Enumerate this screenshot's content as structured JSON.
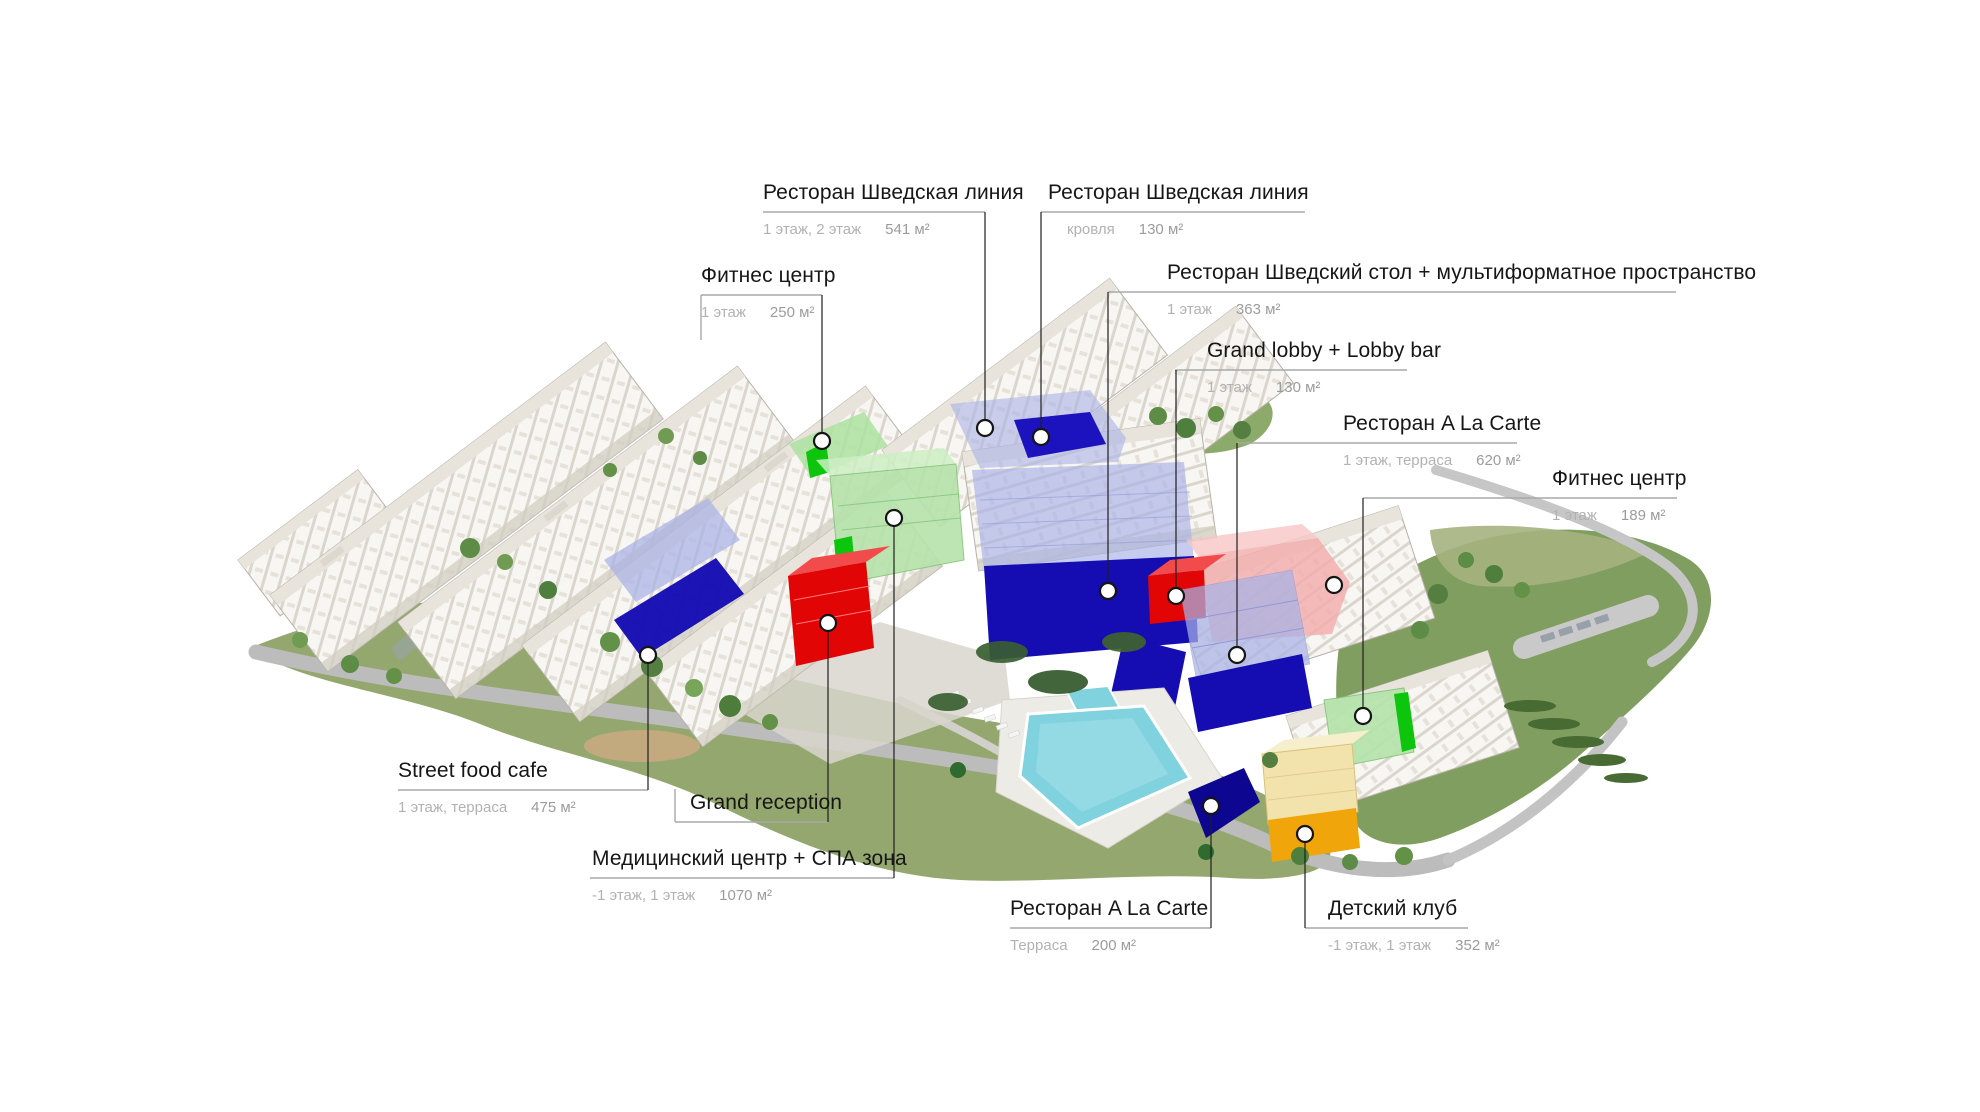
{
  "canvas": {
    "width": 1980,
    "height": 1112,
    "background": "#ffffff"
  },
  "palette": {
    "highlight_navy": "#150cb2",
    "highlight_periwinkle": "#a9b2e6",
    "highlight_bright_green": "#0cc50c",
    "highlight_light_green": "#b5e3ab",
    "highlight_red": "#e10505",
    "highlight_pink": "#f2abab",
    "highlight_amber": "#f0a60a",
    "pool_water": "#7fd2de",
    "leader_line": "#1f1f1f",
    "rule_line": "#a8a8a8",
    "title_text": "#161616",
    "floors_text": "#b2b2b2",
    "area_text": "#9c9c9c"
  },
  "callouts": [
    {
      "id": "restaurant-swedish-line",
      "title": "Ресторан Шведская линия",
      "floors": "1 этаж, 2 этаж",
      "area": "541 м²",
      "x": 763,
      "rule": {
        "x1": 763,
        "x2": 985,
        "y": 212
      },
      "leader": {
        "x": 985,
        "y1": 212,
        "y2": 428
      },
      "dot": {
        "x": 985,
        "y": 428
      }
    },
    {
      "id": "restaurant-swedish-line-roof",
      "title": "Ресторан Шведская линия",
      "floors": "кровля",
      "area": "130 м²",
      "x": 1048,
      "sub_x": 1067,
      "rule": {
        "x1": 1041,
        "x2": 1305,
        "y": 212
      },
      "leader": {
        "x": 1041,
        "y1": 212,
        "y2": 437
      },
      "dot": {
        "x": 1041,
        "y": 437
      }
    },
    {
      "id": "fitness-center-west",
      "title": "Фитнес центр",
      "floors": "1 этаж",
      "area": "250 м²",
      "x": 701,
      "rule": {
        "x1": 701,
        "x2": 822,
        "y": 295
      },
      "leader": {
        "x": 822,
        "y1": 295,
        "y2": 441
      },
      "dot": {
        "x": 822,
        "y": 441
      },
      "stub": {
        "x": 701,
        "y1": 295,
        "y2": 340
      }
    },
    {
      "id": "restaurant-buffet-multiformat",
      "title": "Ресторан Шведский стол + мультиформатное пространство",
      "floors": "1 этаж",
      "area": "363 м²",
      "x": 1167,
      "rule": {
        "x1": 1108,
        "x2": 1676,
        "y": 292
      },
      "leader": {
        "x": 1108,
        "y1": 292,
        "y2": 591
      },
      "dot": {
        "x": 1108,
        "y": 591
      }
    },
    {
      "id": "grand-lobby",
      "title": "Grand lobby + Lobby bar",
      "floors": "1 этаж",
      "area": "130 м²",
      "x": 1207,
      "rule": {
        "x1": 1175,
        "x2": 1407,
        "y": 370
      },
      "leader": {
        "x": 1176,
        "y1": 370,
        "y2": 596
      },
      "dot": {
        "x": 1176,
        "y": 596
      }
    },
    {
      "id": "restaurant-a-la-carte",
      "title": "Ресторан A La Carte",
      "floors": "1 этаж, терраса",
      "area": "620 м²",
      "x": 1343,
      "rule": {
        "x1": 1237,
        "x2": 1517,
        "y": 443
      },
      "leader": {
        "x": 1237,
        "y1": 443,
        "y2": 655
      },
      "dot": {
        "x": 1237,
        "y": 655
      }
    },
    {
      "id": "fitness-center-east",
      "title": "Фитнес центр",
      "floors": "1 этаж",
      "area": "189 м²",
      "x": 1552,
      "rule": {
        "x1": 1363,
        "x2": 1677,
        "y": 498
      },
      "leader": {
        "x": 1363,
        "y1": 498,
        "y2": 716
      },
      "dot": {
        "x": 1363,
        "y": 716
      }
    },
    {
      "id": "street-food-cafe",
      "title": "Street food cafe",
      "floors": "1 этаж, терраса",
      "area": "475 м²",
      "x": 398,
      "rule": {
        "x1": 398,
        "x2": 648,
        "y": 790
      },
      "leader": {
        "x": 648,
        "y1": 790,
        "y2": 655
      },
      "dot": {
        "x": 648,
        "y": 655
      }
    },
    {
      "id": "grand-reception",
      "title": "Grand reception",
      "x": 690,
      "rule": {
        "x1": 675,
        "x2": 828,
        "y": 822
      },
      "leader": {
        "x": 828,
        "y1": 822,
        "y2": 623
      },
      "dot": {
        "x": 828,
        "y": 623
      },
      "stub": {
        "x": 675,
        "y1": 822,
        "y2": 789
      }
    },
    {
      "id": "medical-center-spa",
      "title": "Медицинский центр + СПА зона",
      "floors": "-1 этаж, 1 этаж",
      "area": "1070 м²",
      "x": 592,
      "rule": {
        "x1": 590,
        "x2": 894,
        "y": 878
      },
      "leader": {
        "x": 894,
        "y1": 878,
        "y2": 518
      },
      "dot": {
        "x": 894,
        "y": 518
      }
    },
    {
      "id": "restaurant-a-la-carte-terrace",
      "title": "Ресторан A La Carte",
      "floors": "Терраса",
      "area": "200 м²",
      "x": 1010,
      "rule": {
        "x1": 1010,
        "x2": 1211,
        "y": 928
      },
      "leader": {
        "x": 1211,
        "y1": 928,
        "y2": 806
      },
      "dot": {
        "x": 1211,
        "y": 806
      }
    },
    {
      "id": "kids-club",
      "title": "Детский клуб",
      "floors": "-1 этаж, 1 этаж",
      "area": "352 м²",
      "x": 1328,
      "rule": {
        "x1": 1305,
        "x2": 1468,
        "y": 928
      },
      "leader": {
        "x": 1305,
        "y1": 928,
        "y2": 834
      },
      "dot": {
        "x": 1305,
        "y": 834
      }
    }
  ],
  "extra_markers": [
    {
      "id": "roof-terrace-marker",
      "x": 1334,
      "y": 585
    }
  ]
}
